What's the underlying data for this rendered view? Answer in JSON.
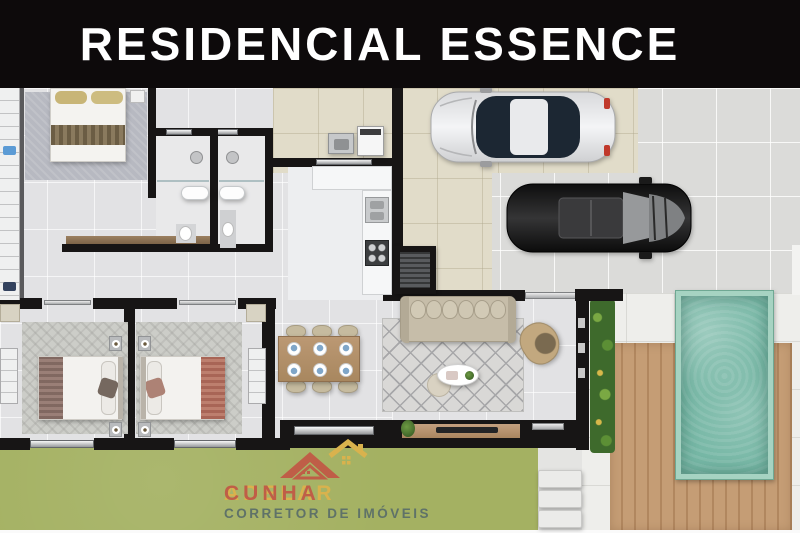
{
  "banner": {
    "title": "RESIDENCIAL ESSENCE"
  },
  "logo": {
    "brand_gold": "ADELAR",
    "brand_red": "CUNHA",
    "tagline": "CORRETOR DE IMÓVEIS",
    "icon": "house-roofs-icon"
  },
  "plan": {
    "depicted_elements": [
      "master-bedroom",
      "bathroom-left",
      "bathroom-right",
      "laundry-area",
      "kitchen",
      "dining-table-6-seats",
      "living-room-sofa",
      "tv-console",
      "bedroom-2",
      "bedroom-3",
      "garage-white-car",
      "garage-black-car",
      "swimming-pool",
      "wood-deck",
      "vertical-garden",
      "lawn",
      "steps"
    ]
  },
  "palette": {
    "banner_bg": "#0d0a0b",
    "banner_text": "#ffffff",
    "wall": "#171515",
    "interior_tile": "#e2e2e4",
    "beige_tile": "#e1dcc9",
    "driveway_tile": "#dbdbd9",
    "patio_tile": "#eeeeeb",
    "deck_wood": "#c59d75",
    "deck_wood_dark": "#b1875f",
    "pool_water": "#76b7a5",
    "pool_frame": "#a6d3c2",
    "grass": "#a4b162",
    "plant_green": "#3e6a2c",
    "logo_gold": "#d9b24d",
    "logo_red": "#bf5e47",
    "logo_slate": "#5f7268"
  }
}
